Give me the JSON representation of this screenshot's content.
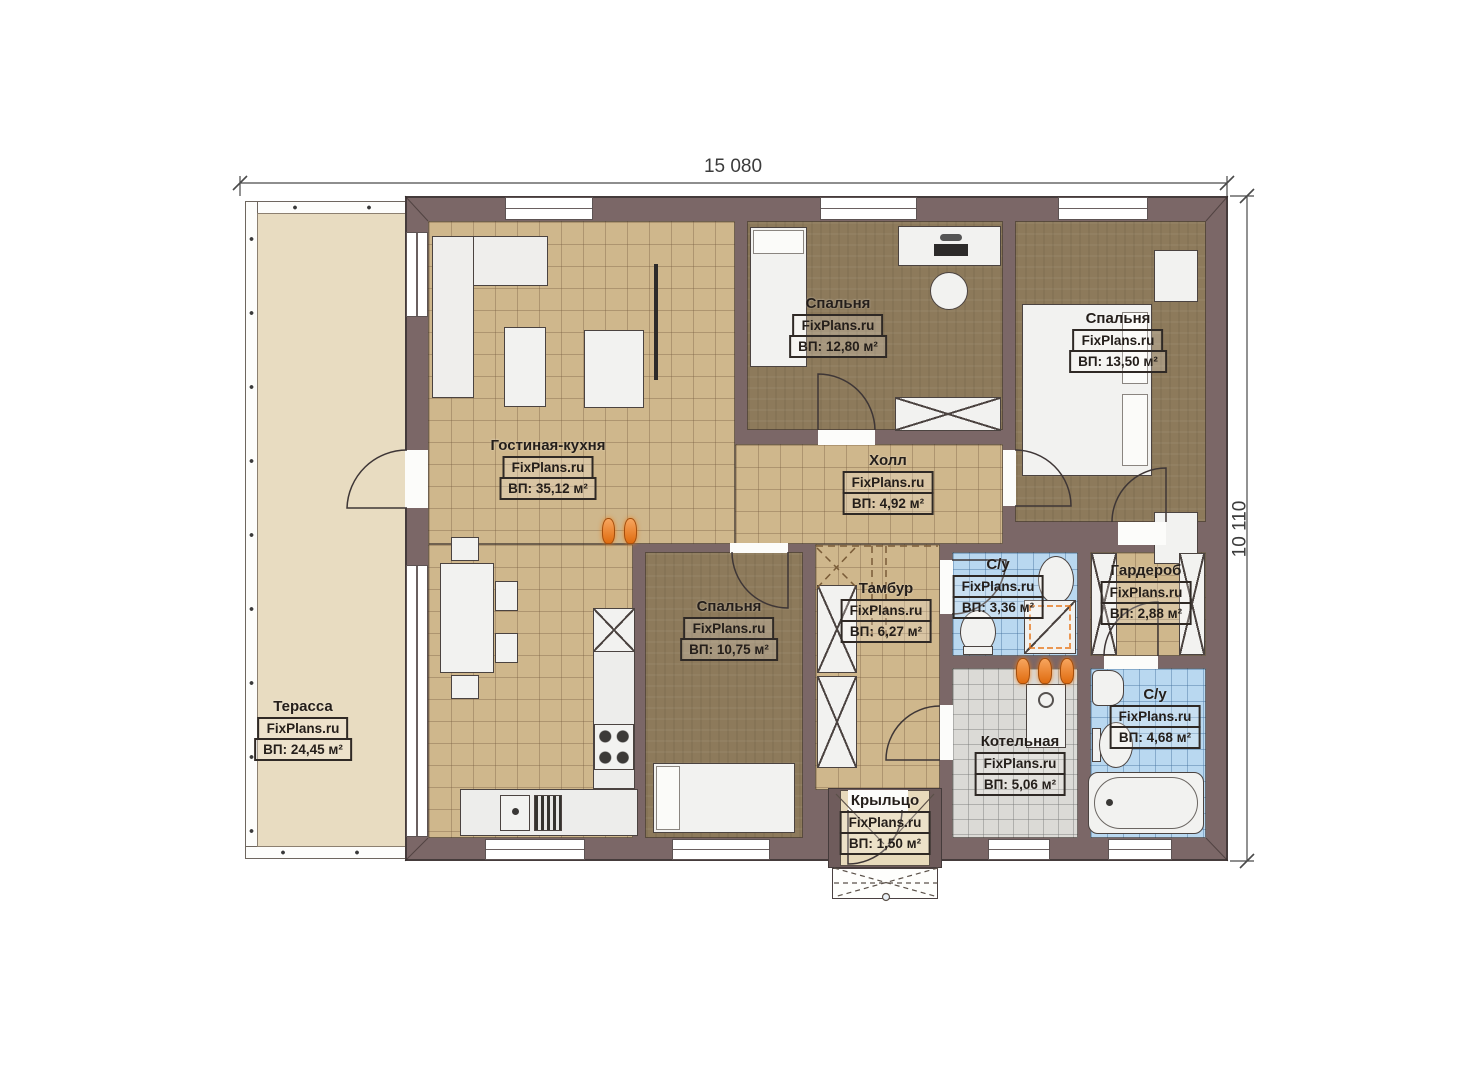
{
  "plan": {
    "title": "Single storey house floor plan",
    "dimensions": {
      "width_label": "15 080",
      "height_label": "10 110"
    },
    "watermark": "FixPlans.ru",
    "rooms": [
      {
        "id": "terrace",
        "name": "Терасса",
        "area_label": "ВП: 24,45 м²"
      },
      {
        "id": "living-kitchen",
        "name": "Гостиная-кухня",
        "area_label": "ВП: 35,12 м²"
      },
      {
        "id": "bedroom-1",
        "name": "Спальня",
        "area_label": "ВП: 12,80 м²"
      },
      {
        "id": "bedroom-2",
        "name": "Спальня",
        "area_label": "ВП: 13,50 м²"
      },
      {
        "id": "hall",
        "name": "Холл",
        "area_label": "ВП: 4,92 м²"
      },
      {
        "id": "bedroom-3",
        "name": "Спальня",
        "area_label": "ВП: 10,75 м²"
      },
      {
        "id": "vestibule",
        "name": "Тамбур",
        "area_label": "ВП: 6,27 м²"
      },
      {
        "id": "bathroom-1",
        "name": "С/у",
        "area_label": "ВП: 3,36 м²"
      },
      {
        "id": "wardrobe",
        "name": "Гардероб",
        "area_label": "ВП: 2,88 м²"
      },
      {
        "id": "boiler-room",
        "name": "Котельная",
        "area_label": "ВП: 5,06 м²"
      },
      {
        "id": "bathroom-2",
        "name": "С/у",
        "area_label": "ВП: 4,68 м²"
      },
      {
        "id": "porch",
        "name": "Крыльцо",
        "area_label": "ВП: 1,50 м²"
      }
    ],
    "colors": {
      "wall": "#7b6767",
      "tile_tan": "#cfb78c",
      "wood_brown": "#8d7a5b",
      "tile_blue": "#b9d8f0",
      "tile_gray": "#dbdad6",
      "terrace": "#e8dcc1",
      "porch": "#e7dabb",
      "accent_orange": "#e06c10",
      "label_ink": "#241e1a"
    }
  }
}
